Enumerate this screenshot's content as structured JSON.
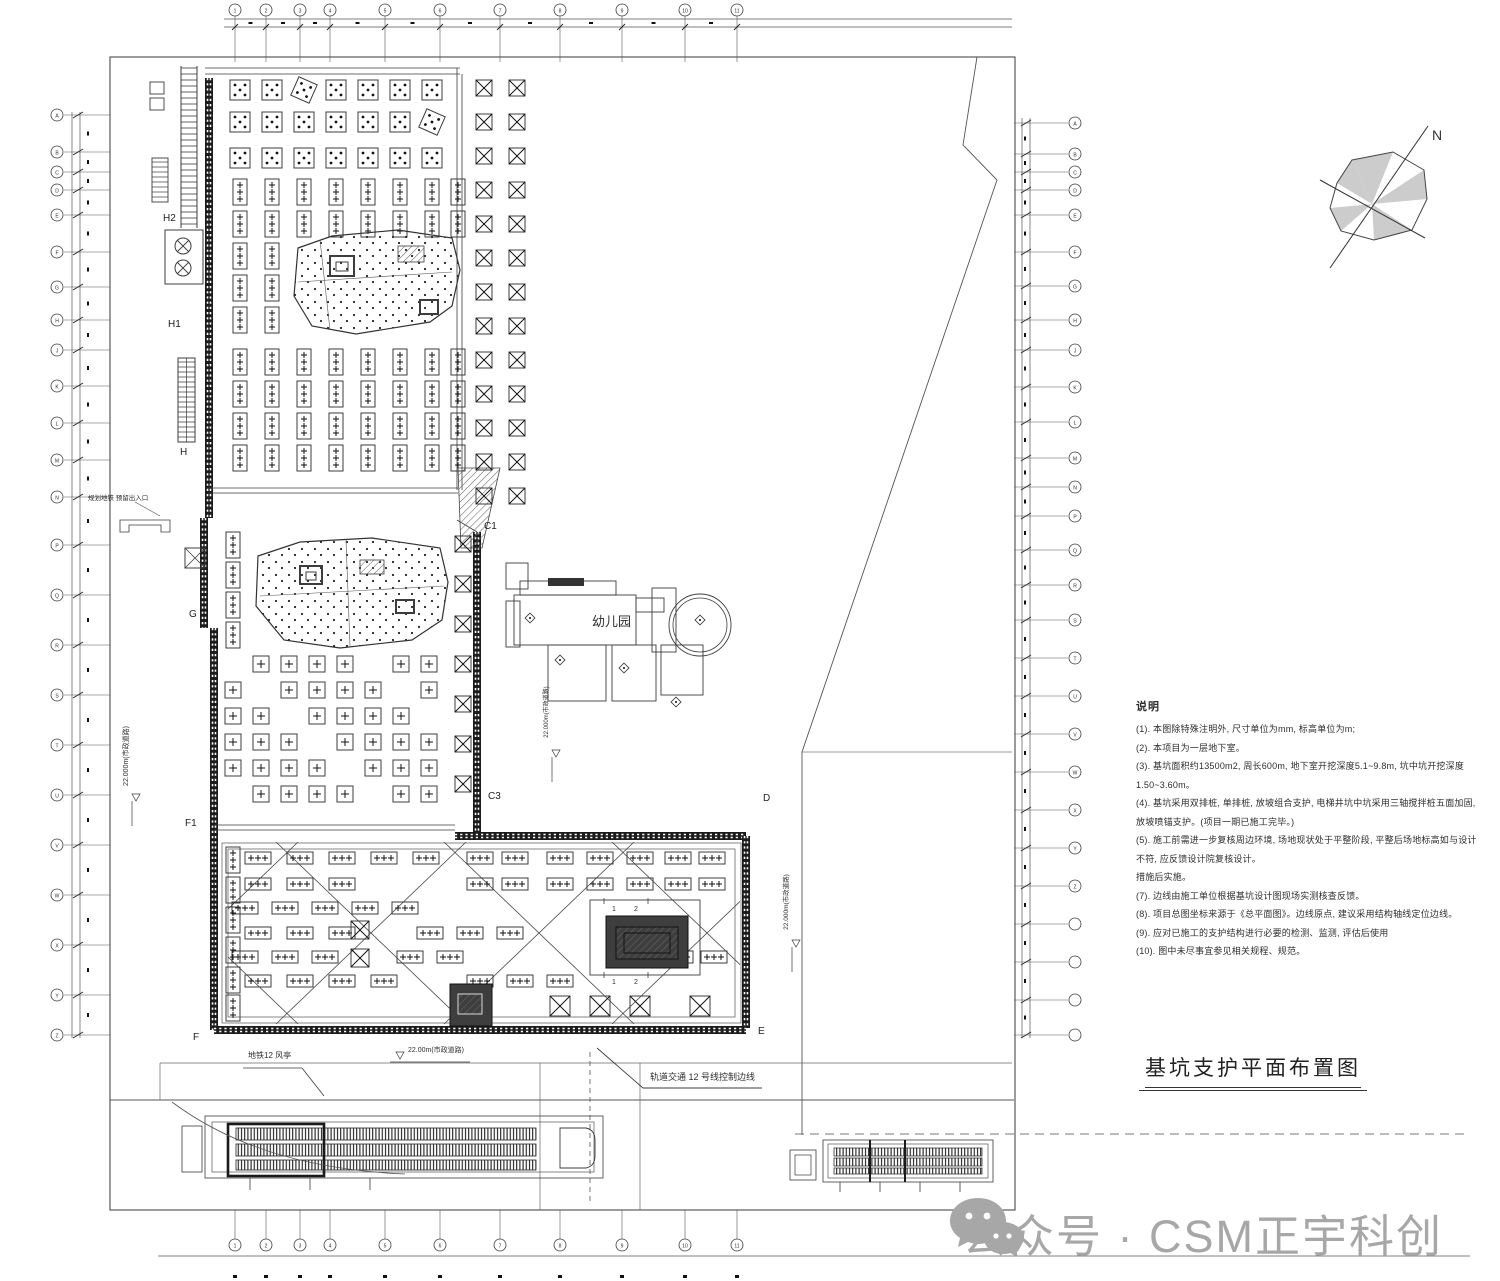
{
  "title_block": {
    "title": "基坑支护平面布置图"
  },
  "watermark": {
    "text": "公众号 · CSM正宇科创",
    "color": "#a7a7a7"
  },
  "north": {
    "label": "N"
  },
  "notes": {
    "heading": "说明",
    "lines": [
      "(1). 本图除特殊注明外, 尺寸单位为mm, 标高单位为m;",
      "(2). 本项目为一层地下室。",
      "(3). 基坑面积约13500m2, 周长600m, 地下室开挖深度5.1~9.8m, 坑中坑开挖深度1.50~3.60m。",
      "(4). 基坑采用双排桩, 单排桩, 放坡组合支护, 电梯井坑中坑采用三轴搅拌桩五面加固, 放坡喷锚支护。(项目一期已施工完毕。)",
      "(5). 施工前需进一步复核周边环境, 场地现状处于平整阶段, 平整后场地标高如与设计不符, 应反馈设计院复核设计。",
      "措施后实施。",
      "(7). 边线由施工单位根据基坑设计图现场实测核查反馈。",
      "(8). 项目总图坐标来源于《总平面图》。边线原点, 建议采用结构轴线定位边线。",
      "(9). 应对已施工的支护结构进行必要的检测、监测, 评估后使用",
      "(10). 图中未尽事宜参见相关规程、规范。"
    ]
  },
  "labels": {
    "kindergarten": "幼儿园",
    "rail_line": "轨道交通  12 号线控制边线",
    "vent": "地铁12 风亭",
    "exit": "规划地铁 预留出入口",
    "road_v": "22.000m(市政道路)",
    "road_h": "22.00m(市政道路)",
    "detail_marks": [
      "1",
      "2"
    ],
    "axis_points": [
      "H2",
      "H1",
      "H",
      "G",
      "F1",
      "F",
      "C1",
      "C3",
      "D",
      "E"
    ]
  },
  "grid": {
    "top": [
      "1",
      "2",
      "3",
      "4",
      "5",
      "6",
      "7",
      "8",
      "9",
      "10",
      "11"
    ],
    "bottom": [
      "1",
      "2",
      "3",
      "4",
      "5",
      "6",
      "7",
      "8",
      "9",
      "10",
      "11"
    ],
    "left": [
      "A",
      "B",
      "C",
      "D",
      "E",
      "F",
      "G",
      "H",
      "J",
      "K",
      "L",
      "M",
      "N",
      "P",
      "Q",
      "R",
      "S",
      "T",
      "U",
      "V",
      "W",
      "X",
      "Y",
      "Z"
    ],
    "right": [
      "A",
      "B",
      "C",
      "D",
      "E",
      "F",
      "G",
      "H",
      "J",
      "K",
      "L",
      "M",
      "N",
      "P",
      "Q",
      "R",
      "S",
      "T",
      "U",
      "V",
      "W",
      "X",
      "Y",
      "Z"
    ]
  }
}
